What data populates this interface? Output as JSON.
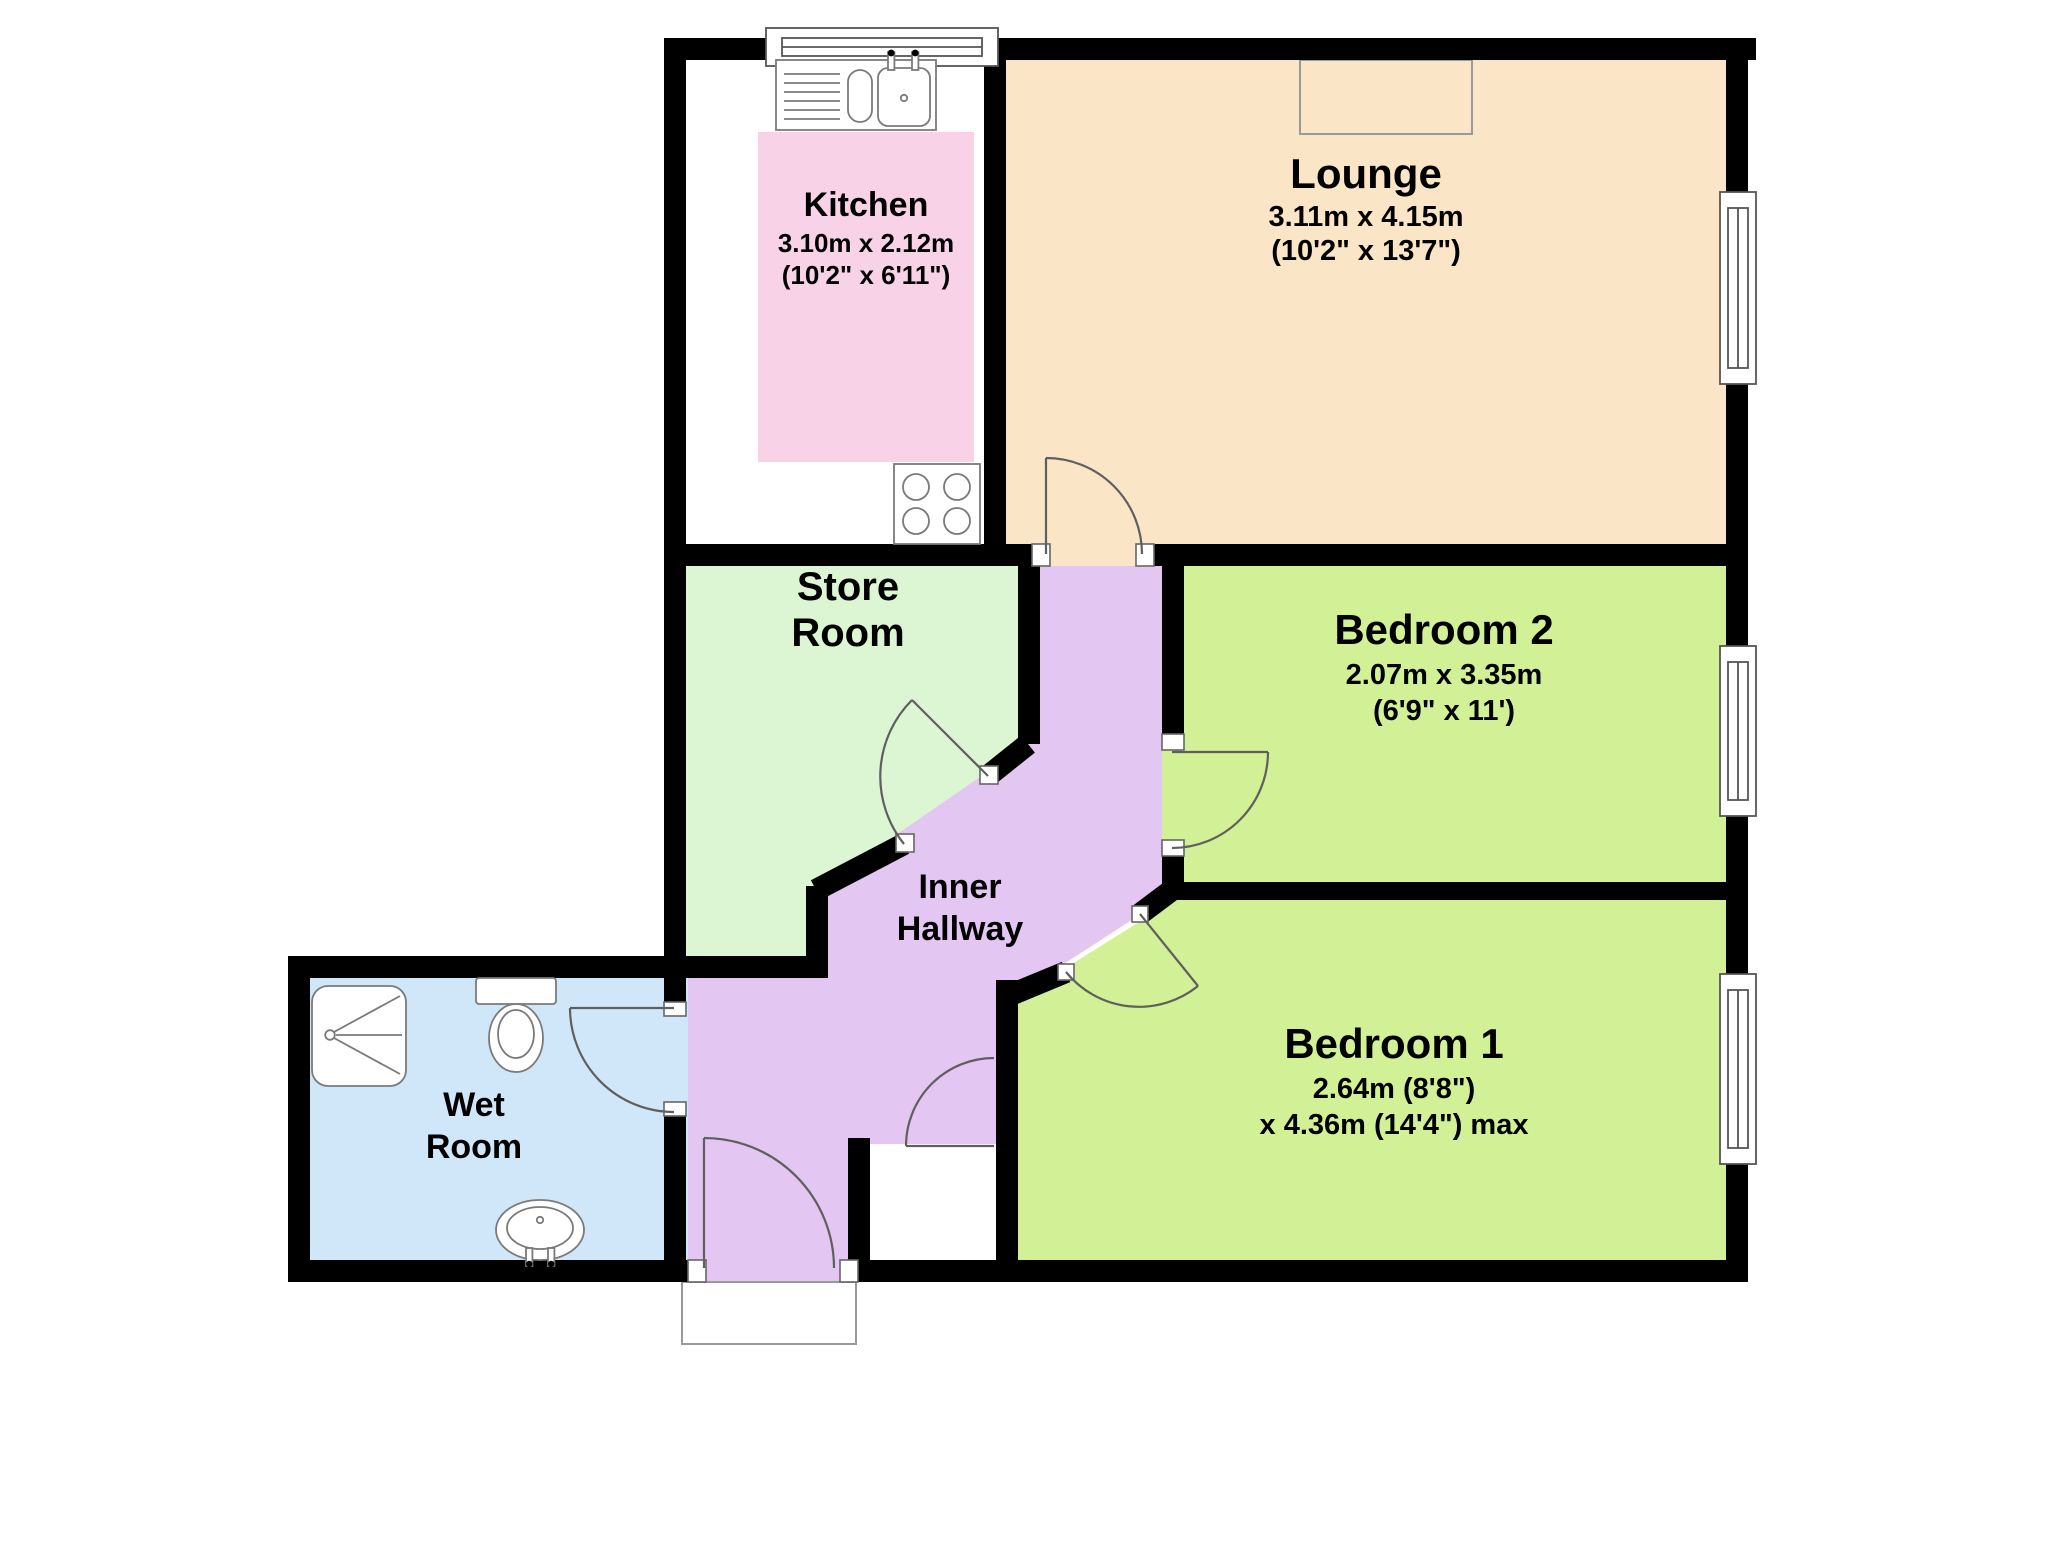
{
  "colors": {
    "background": "#ffffff",
    "wall": "#000000",
    "kitchen": "#f8d3e8",
    "lounge": "#fae5c6",
    "store_room": "#dcf5d2",
    "inner_hallway": "#e3c6f1",
    "wet_room": "#cfe7f8",
    "bedroom": "#d2f095",
    "door_arc": "#5f5f5f",
    "fixture_stroke": "#7a7a7a",
    "window_stroke": "#555555"
  },
  "rooms": {
    "kitchen": {
      "name": "Kitchen",
      "dims_metric": "3.10m x 2.12m",
      "dims_imperial": "(10'2\" x 6'11\")"
    },
    "lounge": {
      "name": "Lounge",
      "dims_metric": "3.11m x 4.15m",
      "dims_imperial": "(10'2\" x 13'7\")"
    },
    "store_room": {
      "name_line1": "Store",
      "name_line2": "Room"
    },
    "inner_hallway": {
      "name_line1": "Inner",
      "name_line2": "Hallway"
    },
    "wet_room": {
      "name_line1": "Wet",
      "name_line2": "Room"
    },
    "bedroom_2": {
      "name": "Bedroom 2",
      "dims_metric": "2.07m x 3.35m",
      "dims_imperial": "(6'9\" x 11')"
    },
    "bedroom_1": {
      "name": "Bedroom 1",
      "dims_line1": "2.64m (8'8\")",
      "dims_line2": "x 4.36m (14'4\") max"
    }
  }
}
